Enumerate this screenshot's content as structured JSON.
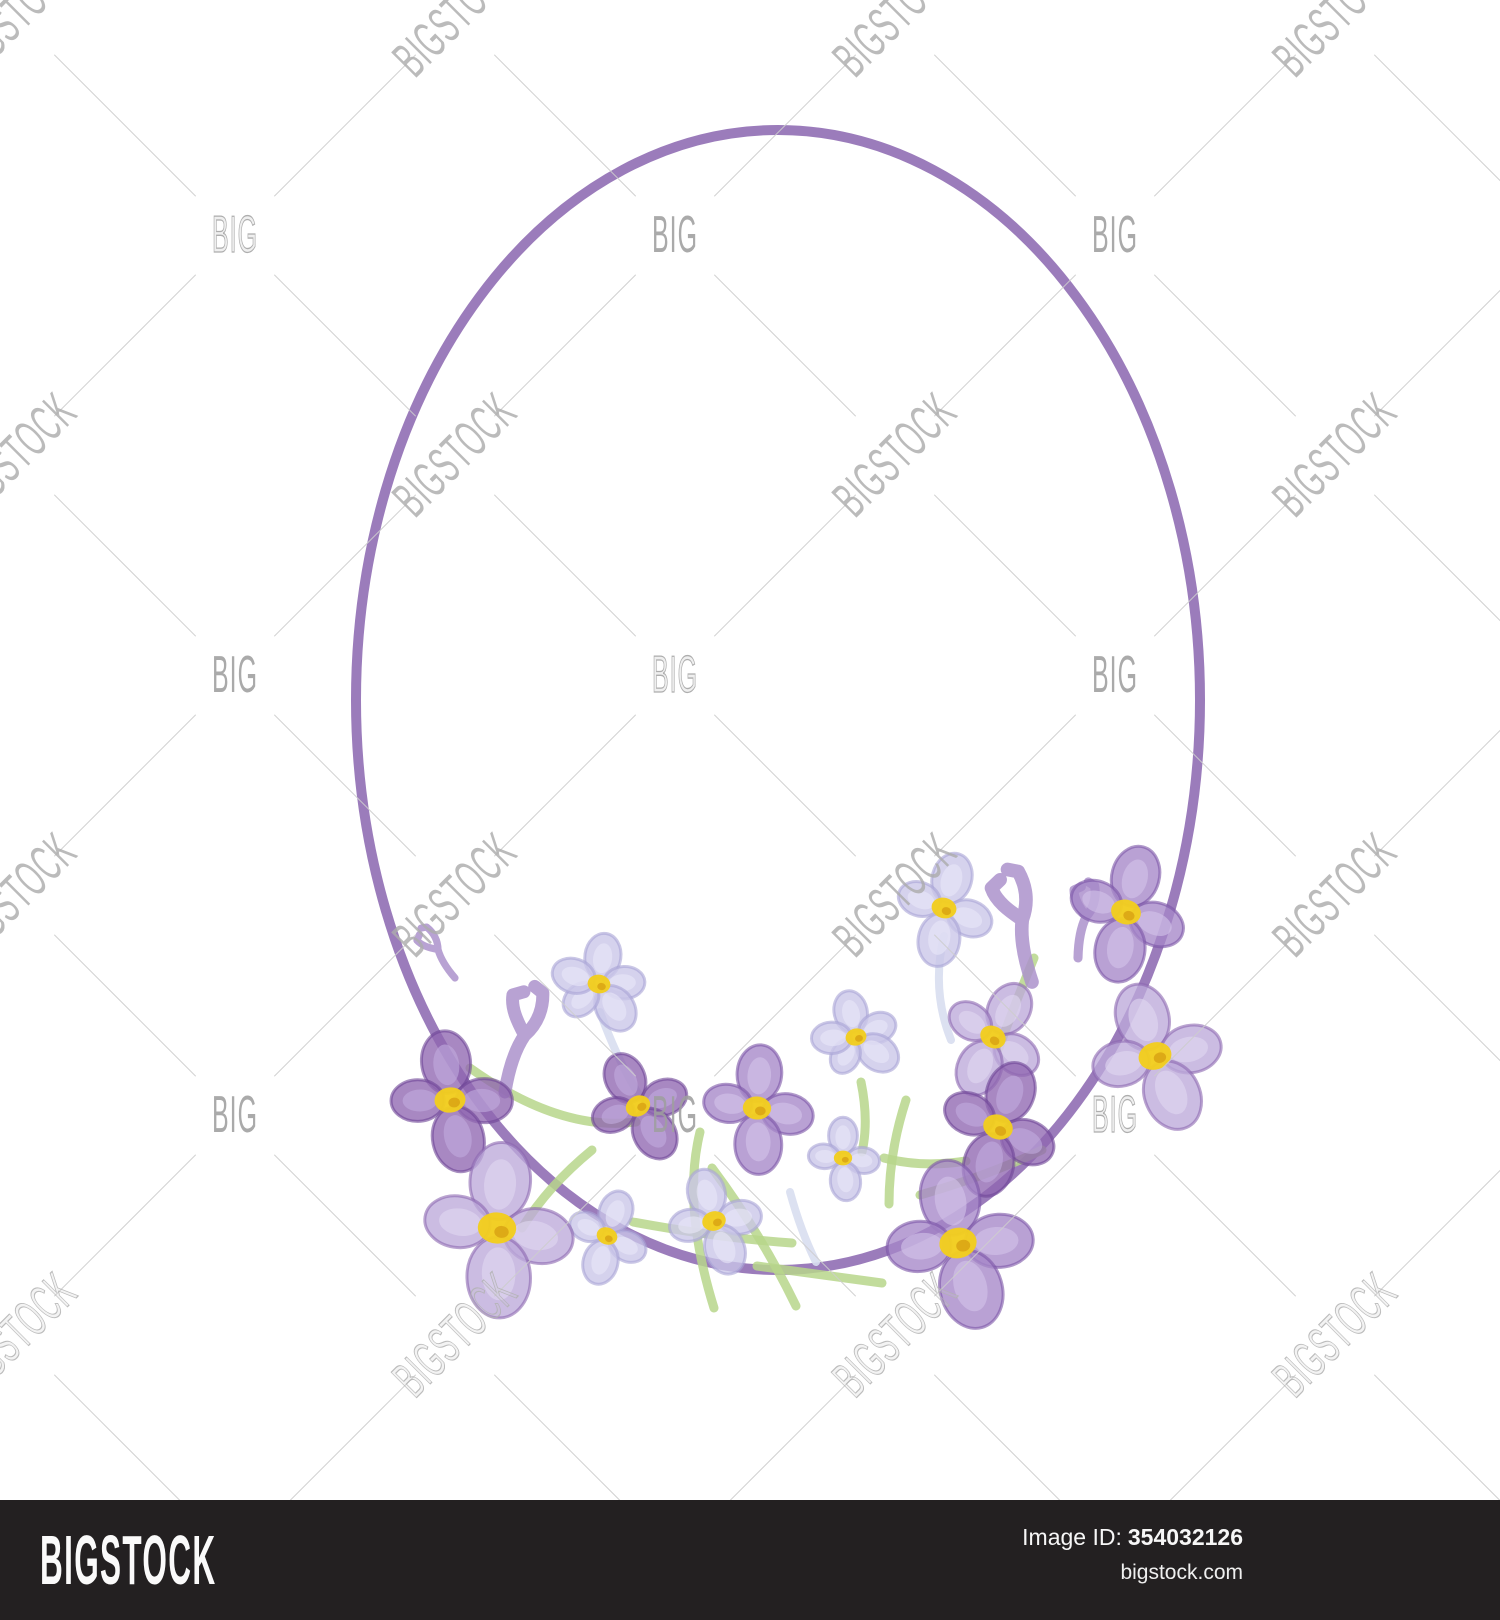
{
  "page": {
    "width": 1500,
    "height": 1620,
    "background": "#ffffff"
  },
  "watermark": {
    "big_label": "BIG",
    "stock_label": "BIGSTOCK",
    "grid_origin": 15,
    "grid_step": 220,
    "line_color": "#cdcdcd",
    "text_color": "#9e9e9e"
  },
  "illustration": {
    "description": "watercolor oval frame with purple lilac flowers",
    "frame": {
      "cx": 778,
      "cy": 700,
      "rx": 422,
      "ry": 570,
      "color": "#9b7cbb",
      "stroke_width": 10
    },
    "palette": {
      "dark": {
        "fill": "#9066b1",
        "stroke": "#6e4596",
        "hi": "#c2abdd"
      },
      "mid": {
        "fill": "#a586c8",
        "stroke": "#7b55a7",
        "hi": "#d3c5ea"
      },
      "pale": {
        "fill": "#bda9da",
        "stroke": "#8c68b0",
        "hi": "#e1d9f2"
      },
      "lavender": {
        "fill": "#c9c5e8",
        "stroke": "#a9a3d5",
        "hi": "#eae8f8"
      },
      "center_yellow": "#f2cd1f",
      "center_deep": "#d9a314",
      "stem_green": "#b7d68b",
      "stem_blue": "#d8def0",
      "branch": "#ac92cb"
    },
    "flowers": [
      {
        "name": "small-top-left",
        "x": 599,
        "y": 984,
        "r": 50,
        "rot": 8,
        "petals": 5,
        "shade": "lavender"
      },
      {
        "name": "small-top-right",
        "x": 944,
        "y": 908,
        "r": 55,
        "rot": 15,
        "petals": 4,
        "shade": "lavender"
      },
      {
        "name": "small-mid",
        "x": 856,
        "y": 1037,
        "r": 46,
        "rot": -12,
        "petals": 5,
        "shade": "lavender"
      },
      {
        "name": "small-mid-low",
        "x": 843,
        "y": 1158,
        "r": 40,
        "rot": 0,
        "petals": 4,
        "shade": "lavender"
      },
      {
        "name": "pale-right-mid",
        "x": 993,
        "y": 1037,
        "r": 58,
        "rot": 30,
        "petals": 4,
        "shade": "pale"
      },
      {
        "name": "pale-far-right",
        "x": 1155,
        "y": 1056,
        "r": 73,
        "rot": -18,
        "petals": 4,
        "shade": "pale"
      },
      {
        "name": "dark-center-left",
        "x": 638,
        "y": 1106,
        "r": 55,
        "rot": -25,
        "petals": 4,
        "shade": "dark"
      },
      {
        "name": "mid-center",
        "x": 757,
        "y": 1108,
        "r": 62,
        "rot": 4,
        "petals": 4,
        "shade": "mid"
      },
      {
        "name": "dark-left",
        "x": 450,
        "y": 1100,
        "r": 68,
        "rot": -6,
        "petals": 4,
        "shade": "dark"
      },
      {
        "name": "mid-top-right",
        "x": 1126,
        "y": 912,
        "r": 66,
        "rot": 15,
        "petals": 4,
        "shade": "mid"
      },
      {
        "name": "dark-right",
        "x": 998,
        "y": 1127,
        "r": 66,
        "rot": 20,
        "petals": 4,
        "shade": "dark"
      },
      {
        "name": "small-bottom-left",
        "x": 607,
        "y": 1236,
        "r": 46,
        "rot": 20,
        "petals": 4,
        "shade": "lavender"
      },
      {
        "name": "small-bottom-mid",
        "x": 714,
        "y": 1221,
        "r": 52,
        "rot": -15,
        "petals": 4,
        "shade": "lavender"
      },
      {
        "name": "pale-bottom-left",
        "x": 497,
        "y": 1228,
        "r": 84,
        "rot": 4,
        "petals": 4,
        "shade": "pale"
      },
      {
        "name": "mid-bottom-right",
        "x": 958,
        "y": 1243,
        "r": 82,
        "rot": -10,
        "petals": 4,
        "shade": "mid"
      }
    ],
    "branches": [
      {
        "x": 505,
        "y": 1092,
        "rot": 22,
        "scale": 1.0
      },
      {
        "x": 1032,
        "y": 982,
        "rot": -6,
        "scale": 1.05
      },
      {
        "x": 455,
        "y": 978,
        "rot": -28,
        "scale": 0.55
      },
      {
        "x": 1078,
        "y": 958,
        "rot": 14,
        "scale": 0.7
      }
    ],
    "stems_green": [
      "M712,1168 Q760,1232 796,1306",
      "M633,1222 Q720,1238 792,1243",
      "M757,1266 Q830,1276 882,1283",
      "M470,1068 Q560,1132 636,1122",
      "M884,1158 Q922,1168 966,1161",
      "M700,1132 Q682,1205 714,1308",
      "M1034,958 Q1014,1006 999,1048",
      "M861,1082 Q869,1121 862,1152",
      "M592,1150 Q548,1186 522,1228",
      "M906,1100 Q889,1152 889,1204",
      "M920,1195 Q990,1175 1042,1150"
    ],
    "stems_blue": [
      "M600,1012 Q618,1062 641,1098",
      "M944,936 Q931,990 951,1040",
      "M790,1192 Q801,1232 816,1262"
    ]
  },
  "footer": {
    "logo": "BIGSTOCK",
    "image_id_label": "Image ID:",
    "image_id": "354032126",
    "site": "bigstock.com",
    "background": "#232021"
  }
}
